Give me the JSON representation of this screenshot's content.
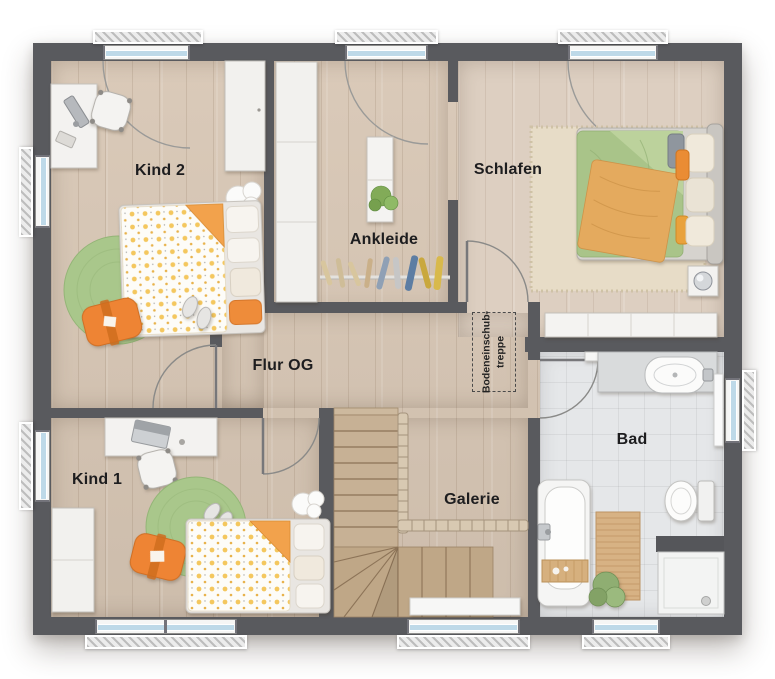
{
  "floorplan": {
    "floor_name": "OG",
    "labels": {
      "kind2": "Kind 2",
      "ankleide": "Ankleide",
      "schlafen": "Schlafen",
      "flur": "Flur OG",
      "kind1": "Kind 1",
      "galerie": "Galerie",
      "bad": "Bad"
    },
    "attic_hatch": {
      "line1": "Bodeneinschub-",
      "line2": "treppe"
    },
    "window_counts": {
      "top": 3,
      "left": 2,
      "bottom": 3,
      "right": 1
    },
    "colors": {
      "wall": "#595a5e",
      "wood_floor": "#d8c7b5",
      "schlafen_floor": "#ddcfc1",
      "bath_tile": "#e5e7e9",
      "stair_wood": "#c7b195",
      "window_glass": "#bed9e8",
      "accent_orange": "#ee8434",
      "rug_green": "#a9c78b",
      "duvet_green": "#a9c489",
      "duvet_dot_yellow": "#f4c75e"
    },
    "furniture": {
      "kind2": [
        "desk",
        "office-chair",
        "wardrobe",
        "single-bed",
        "round-rug",
        "floor-cushion",
        "slippers",
        "cloud-rug"
      ],
      "ankleide": [
        "tall-wardrobe",
        "dresser",
        "plant",
        "clothes-rail-with-hangers"
      ],
      "schlafen": [
        "double-bed",
        "bedside-rug",
        "nightstand-with-lamp",
        "sideboard"
      ],
      "kind1": [
        "desk-with-laptop",
        "office-chair",
        "wardrobe",
        "single-bed",
        "round-rug",
        "floor-cushion",
        "slippers",
        "cloud-rug"
      ],
      "galerie": [
        "winder-staircase",
        "railing",
        "window-bench"
      ],
      "flur": [
        "attic-hatch"
      ],
      "bad": [
        "bathtub",
        "bath-caddy",
        "wooden-mat",
        "towel",
        "vanity-sink",
        "toilet",
        "shower"
      ]
    }
  }
}
